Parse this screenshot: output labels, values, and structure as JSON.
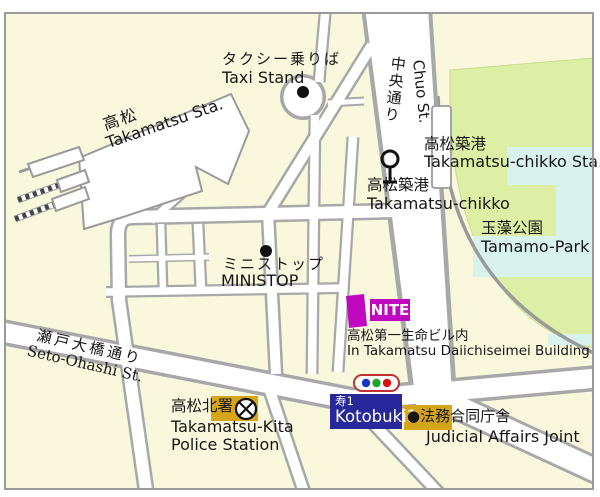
{
  "title": "Takamatsu area access map",
  "labels": {
    "taxi": {
      "jp": "タクシー乗りば",
      "en": "Taxi Stand"
    },
    "station": {
      "jp": "高松",
      "en": "Takamatsu Sta."
    },
    "chuo": {
      "jp": "中央通り",
      "en": "Chuo St."
    },
    "chikko_sta": {
      "jp": "高松築港",
      "en": "Takamatsu-chikko Sta."
    },
    "chikko_stop": {
      "jp": "高松築港",
      "en": "Takamatsu-chikko"
    },
    "park": {
      "jp": "玉藻公園",
      "en": "Tamamo-Park"
    },
    "ministop": {
      "jp": "ミニストップ",
      "en": "MINISTOP"
    },
    "nite": {
      "label": "NITE",
      "note_jp": "高松第一生命ビル内",
      "note_en": "In Takamatsu Daiichiseimei Building"
    },
    "seto": {
      "jp": "瀬戸大橋通り",
      "en": "Seto-Ohashi St."
    },
    "police": {
      "jp": "高松北署",
      "en_line1": "Takamatsu-Kita",
      "en_line2": "Police Station"
    },
    "kotobuki": {
      "jp": "寿1",
      "en": "Kotobuki1"
    },
    "judicial": {
      "jp": "●法務合同庁舎",
      "en": "Judicial Affairs Joint"
    }
  },
  "icons": {
    "taxi_dot": "poi-dot",
    "ministop_dot": "poi-dot",
    "tram_stop": "station-stop-symbol",
    "police": "circle-x-police-symbol",
    "traffic_light": "three-light-signal"
  },
  "colors": {
    "background": "#FAF8DC",
    "street_fill": "#FFFFFF",
    "street_casing": "#A8A8A8",
    "park_green": "#DCEFA5",
    "water_cyan": "#D8F2EC",
    "railway_gray": "#9A9A9A",
    "nite_magenta": "#C108C1",
    "kotobuki_navy": "#28289A",
    "marker_gold": "#D5A51A",
    "signal_border_red": "#C03030",
    "signal_blue": "#1535C8",
    "signal_green": "#1FA32A",
    "signal_red": "#E01010",
    "ink": "#161616"
  }
}
